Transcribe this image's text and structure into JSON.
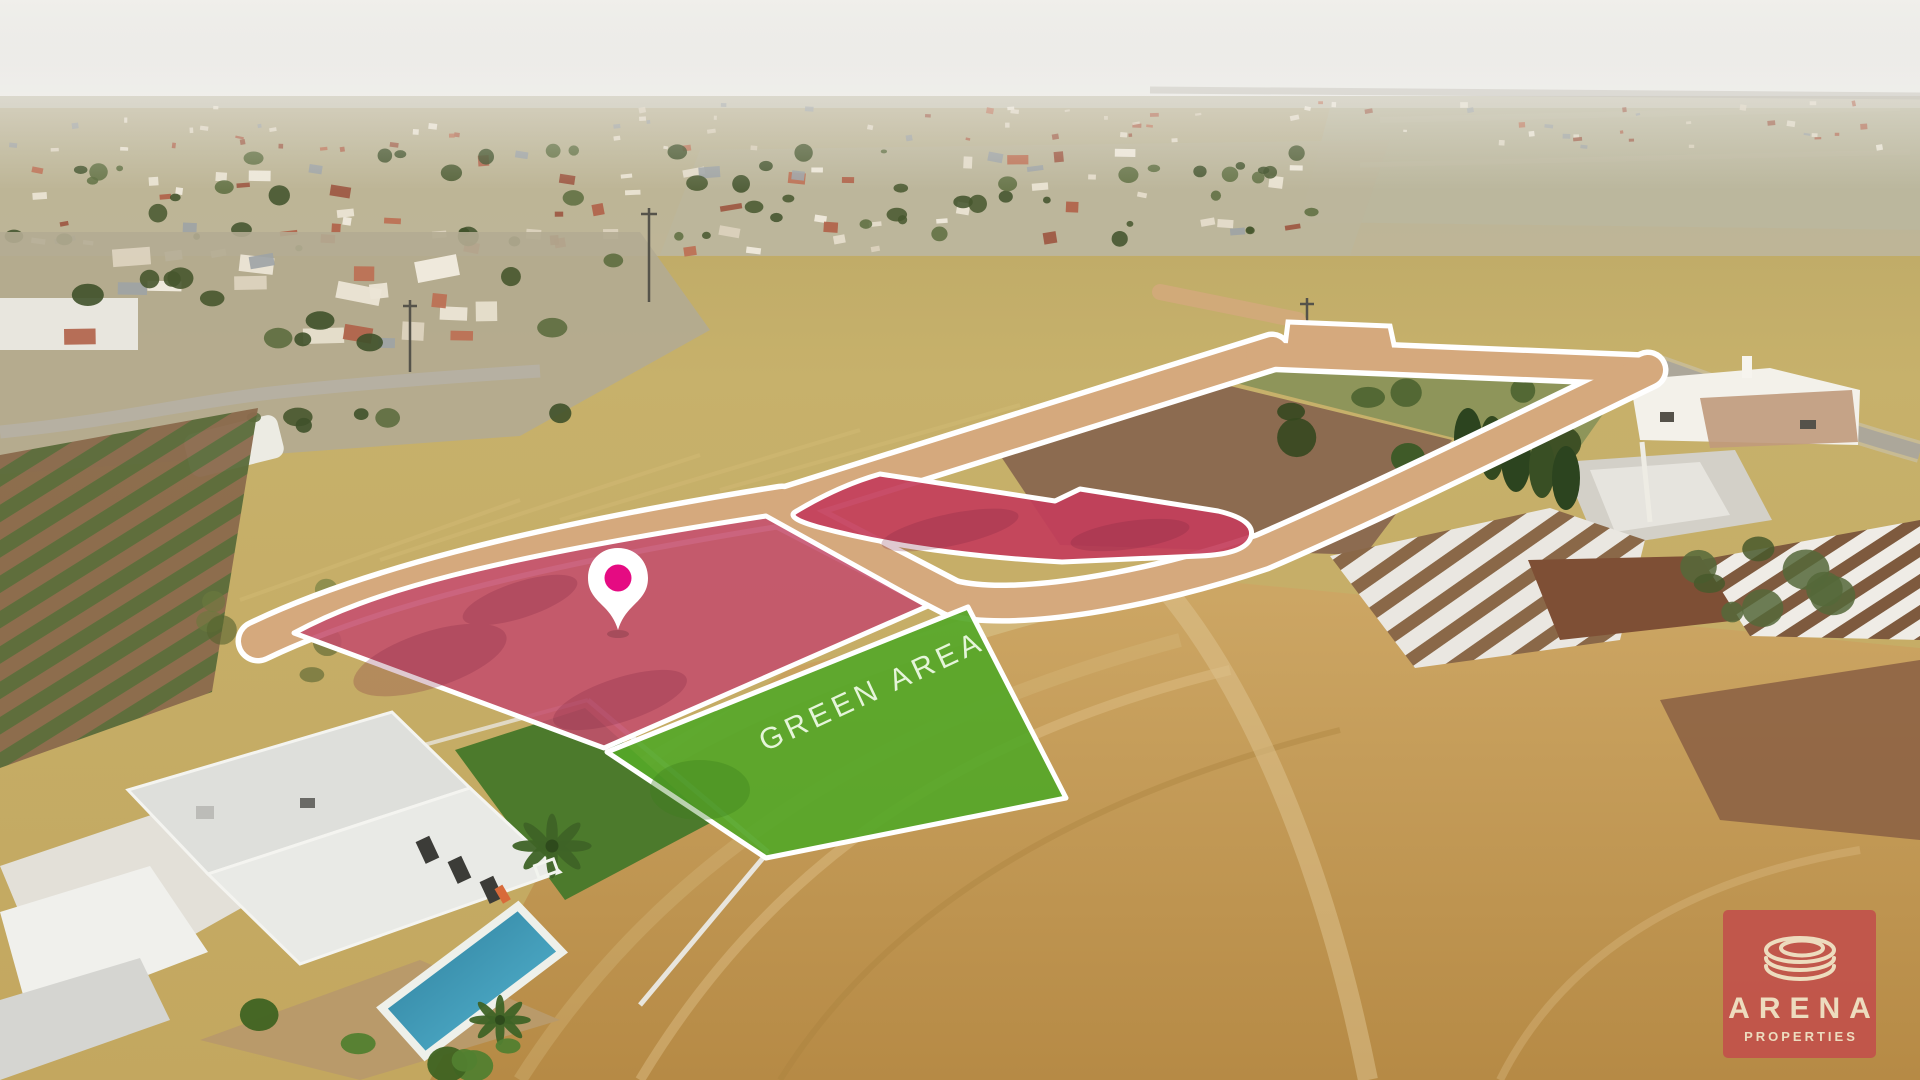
{
  "overlay": {
    "green_area_label": "GREEN AREA",
    "colors": {
      "road": "#d5a97d",
      "plotA": "#c44f6c",
      "plotB": "#c33e5b",
      "green": "#55a728",
      "pin": "#e50b82",
      "outline": "#ffffff"
    }
  },
  "logo": {
    "brand": "ARENA",
    "tagline": "PROPERTIES",
    "bg": "#c2544b",
    "fg": "#f0e1c5"
  }
}
